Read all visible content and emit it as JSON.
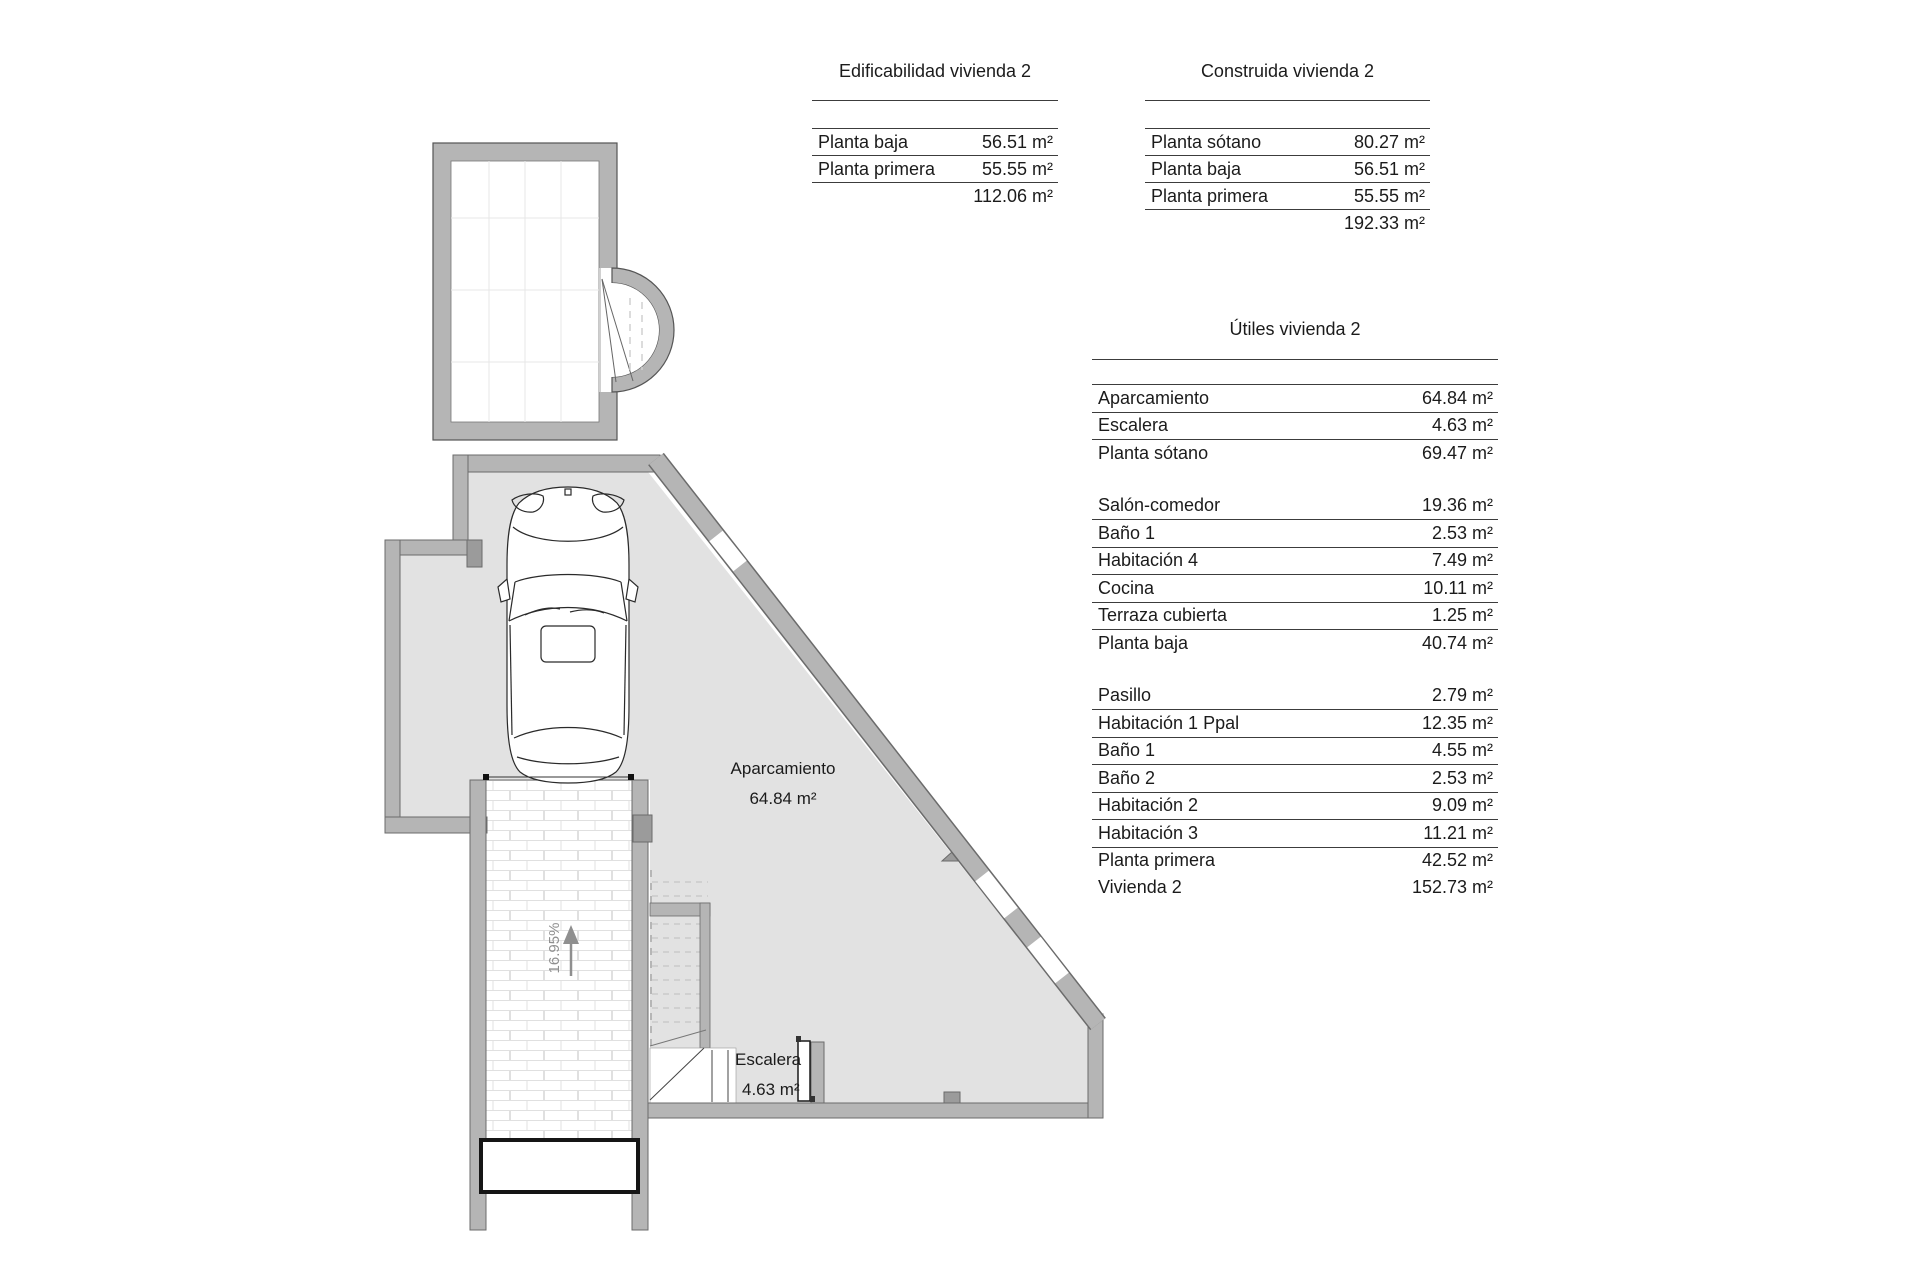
{
  "plan": {
    "labels": {
      "aparcamiento": "Aparcamiento",
      "aparcamiento_area": "64.84 m²",
      "escalera": "Escalera",
      "escalera_area": "4.63 m²",
      "ramp_slope": "16.95%"
    },
    "colors": {
      "wall": "#b5b5b5",
      "wall_dark": "#9b9b9b",
      "floor": "#e2e2e2",
      "outline": "#6b6b6b",
      "slope_gray": "#8f8f8f"
    }
  },
  "tables": {
    "edificabilidad": {
      "title": "Edificabilidad vivienda 2",
      "rows": [
        {
          "label": "Planta baja",
          "value": "56.51 m²"
        },
        {
          "label": "Planta primera",
          "value": "55.55 m²"
        },
        {
          "label": "",
          "value": "112.06 m²",
          "rule": false
        }
      ]
    },
    "construida": {
      "title": "Construida vivienda 2",
      "rows": [
        {
          "label": "Planta sótano",
          "value": "80.27 m²"
        },
        {
          "label": "Planta baja",
          "value": "56.51 m²"
        },
        {
          "label": "Planta primera",
          "value": "55.55 m²"
        },
        {
          "label": "",
          "value": "192.33 m²",
          "rule": false
        }
      ]
    },
    "utiles": {
      "title": "Útiles vivienda 2",
      "sections": [
        [
          {
            "label": "Aparcamiento",
            "value": "64.84 m²"
          },
          {
            "label": "Escalera",
            "value": "4.63 m²"
          },
          {
            "label": "Planta sótano",
            "value": "69.47 m²",
            "rule": false
          }
        ],
        [
          {
            "label": "Salón-comedor",
            "value": "19.36 m²"
          },
          {
            "label": "Baño 1",
            "value": "2.53 m²"
          },
          {
            "label": "Habitación 4",
            "value": "7.49 m²"
          },
          {
            "label": "Cocina",
            "value": "10.11 m²"
          },
          {
            "label": "Terraza cubierta",
            "value": "1.25 m²"
          },
          {
            "label": "Planta baja",
            "value": "40.74 m²",
            "rule": false
          }
        ],
        [
          {
            "label": "Pasillo",
            "value": "2.79 m²"
          },
          {
            "label": "Habitación 1 Ppal",
            "value": "12.35 m²"
          },
          {
            "label": "Baño 1",
            "value": "4.55 m²"
          },
          {
            "label": "Baño 2",
            "value": "2.53 m²"
          },
          {
            "label": "Habitación 2",
            "value": "9.09 m²"
          },
          {
            "label": "Habitación 3",
            "value": "11.21 m²"
          },
          {
            "label": "Planta primera",
            "value": "42.52 m²",
            "rule": false
          },
          {
            "label": "Vivienda 2",
            "value": "152.73 m²",
            "rule": false
          }
        ]
      ]
    }
  }
}
